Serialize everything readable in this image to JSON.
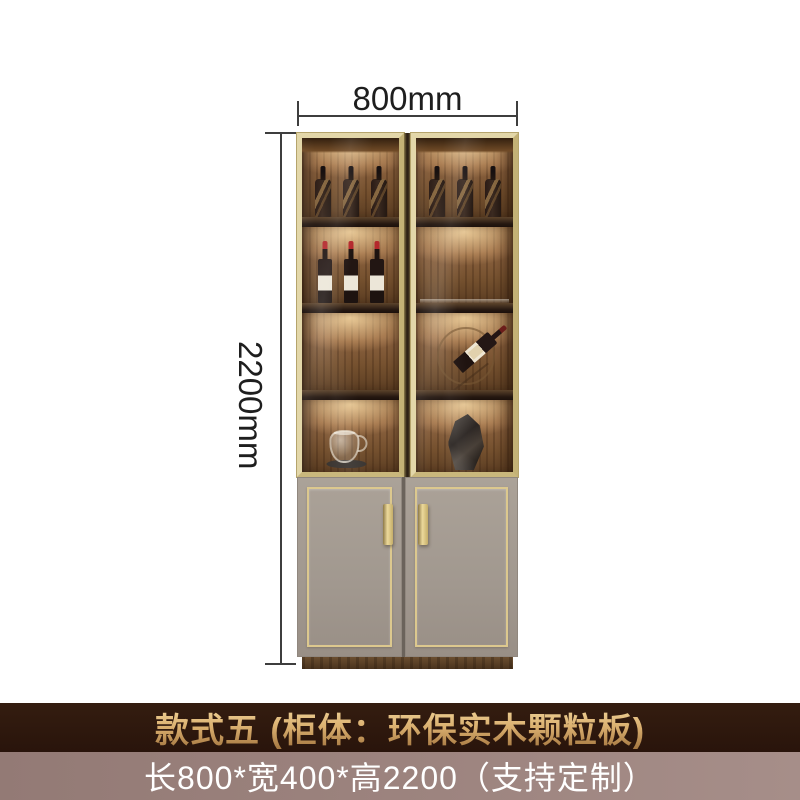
{
  "dimensions": {
    "width_label": "800mm",
    "height_label": "2200mm"
  },
  "banners": {
    "style_banner": {
      "text": "款式五 (柜体：环保实木颗粒板)",
      "bg_color": "#2d170e",
      "text_color": "#d9ae6e"
    },
    "size_banner": {
      "text": "长800*宽400*高2200（支持定制）",
      "bg_color": "#997f7a",
      "text_color": "#ffffff"
    }
  },
  "cabinet": {
    "upper": {
      "left_door": {
        "top_shelf_whisky_bottles": 3,
        "middle_shelf_wine_bottles": 3,
        "bottom_item": "glass-teapot-on-tray"
      },
      "right_door": {
        "top_shelf_whisky_bottles": 3,
        "display_item": "tilted-wine-bottle-on-ring-rack",
        "bottom_item": "faceted-decor-vase"
      }
    },
    "colors": {
      "frame_gold": "#d5c794",
      "interior_wood": "#8d6340",
      "lower_doors_gray": "#a1988f",
      "gold_trim": "#dcc88e",
      "plinth_wood": "#5a4129"
    }
  }
}
